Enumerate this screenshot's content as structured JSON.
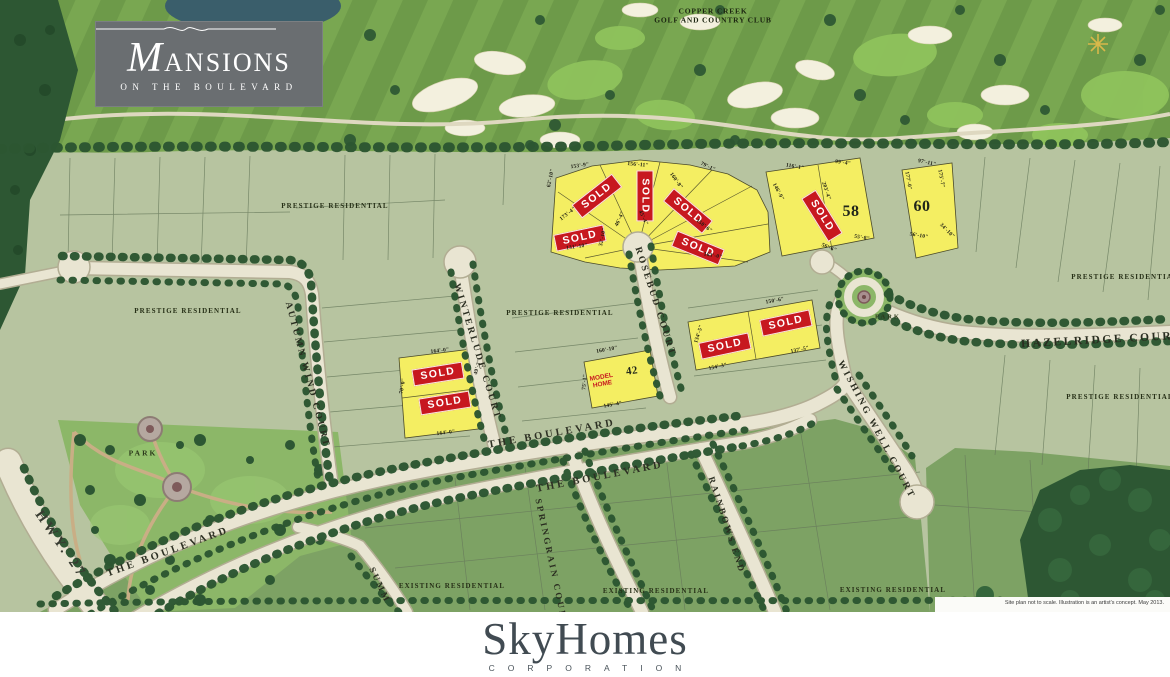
{
  "branding": {
    "project": {
      "name": "MANSIONS",
      "tagline": "ON THE BOULEVARD"
    },
    "developer": {
      "name": "SkyHomes",
      "subtitle": "CORPORATION"
    }
  },
  "golf_club": {
    "name": "COPPER CREEK",
    "name2": "GOLF AND COUNTRY CLUB"
  },
  "streets": {
    "hwy27": "HWY. 27",
    "boulevard": "THE BOULEVARD",
    "autumn_wind": "AUTUMN WIND COURT",
    "winterlude": "WINTERLUDE COURT",
    "rosebud": "ROSEBUD COURT",
    "wishing_well": "WISHING WELL COURT",
    "hazelridge": "HAZELRIDGE COURT",
    "springrain": "SPRINGRAIN COURT",
    "rainbows_end": "RAINBOWS END",
    "summer": "SUMM"
  },
  "areas": {
    "prestige": "PRESTIGE RESIDENTIAL",
    "existing": "EXISTING RESIDENTIAL",
    "park": "PARK"
  },
  "lots": {
    "sold_label": "SOLD",
    "model_home_label": "MODEL HOME",
    "numbers": {
      "n42": "42",
      "n58": "58",
      "n60": "60"
    },
    "dimensions": [
      "153'-9\"",
      "156'-11\"",
      "79'-1\"",
      "62'-10\"",
      "173'-4\"",
      "131'-10\"",
      "160'-8\"",
      "150'-6\"",
      "163'-0\"",
      "46'-4\"",
      "45'-4\"",
      "32'-10\"",
      "116'-1\"",
      "99'-4\"",
      "146'-9\"",
      "203'-4\"",
      "55'-8\"",
      "56'-6\"",
      "97'-11\"",
      "177'-0\"",
      "175'-7\"",
      "56'-10\"",
      "34'-10\"",
      "164'-0\"",
      "70'-0\"",
      "164'-0\"",
      "49'-2\"",
      "160'-10\"",
      "145'-4\"",
      "75'-1\"",
      "150'-6\"",
      "154'-3\"",
      "137'-5\"",
      "134'-5\""
    ]
  },
  "disclaimer": "Site plan not to scale. Illustration is an artist's concept. May 2013.",
  "colors": {
    "sold_red": "#c7181f",
    "lot_yellow": "#f4ee62",
    "dev_green": "#b7c4a0",
    "existing_green": "#7da264",
    "park_green": "#8cb768",
    "golf_green": "#74a24e",
    "tree_green": "#2c5631",
    "road_beige": "#e9e5d2",
    "logo_gray": "#6a6e71",
    "developer_slate": "#414b52",
    "pond_blue": "#3a5e6b"
  }
}
